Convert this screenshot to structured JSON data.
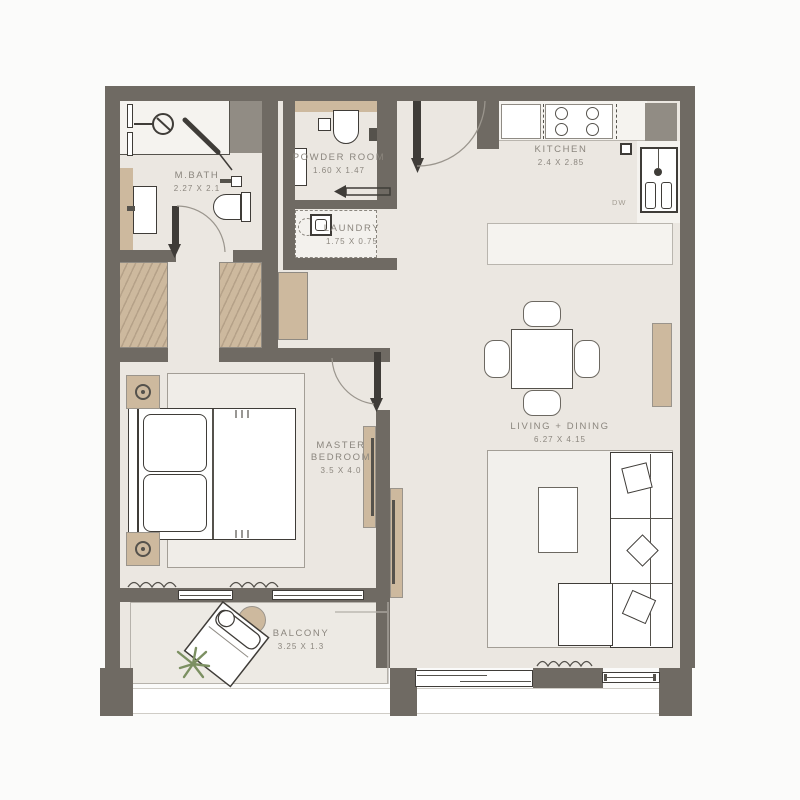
{
  "colors": {
    "background": "#FBFBFA",
    "wall": "#6F6A63",
    "duct": "#918C84",
    "floor": "#EBE7E1",
    "floorLight": "#F5F3EF",
    "white": "#FFFFFF",
    "outline": "#3F3C38",
    "outlineSoft": "#55524C",
    "wood": "#CDB99E",
    "woodDark": "#B5A188",
    "text": "#8B867E",
    "rug": "#F2F0EC",
    "rugBorder": "#A39E96",
    "balconyFloor": "#EDEAE4",
    "plant": "#7C9062",
    "arcLine": "#9A958D",
    "dwText": "#A39D93"
  },
  "rooms": {
    "m_bath": {
      "name": "M.BATH",
      "dims": "2.27 X 2.1"
    },
    "powder_room": {
      "name": "POWDER ROOM",
      "dims": "1.60 X 1.47"
    },
    "laundry": {
      "name": "LAUNDRY",
      "dims": "1.75 X 0.75"
    },
    "kitchen": {
      "name": "KITCHEN",
      "dims": "2.4 X 2.85",
      "appliance_label": "DW"
    },
    "master_bedroom": {
      "name_line1": "MASTER",
      "name_line2": "BEDROOM",
      "dims": "3.5 X 4.0"
    },
    "living_dining": {
      "name": "LIVING + DINING",
      "dims": "6.27 X 4.15"
    },
    "balcony": {
      "name": "BALCONY",
      "dims": "3.25 X 1.3"
    }
  }
}
